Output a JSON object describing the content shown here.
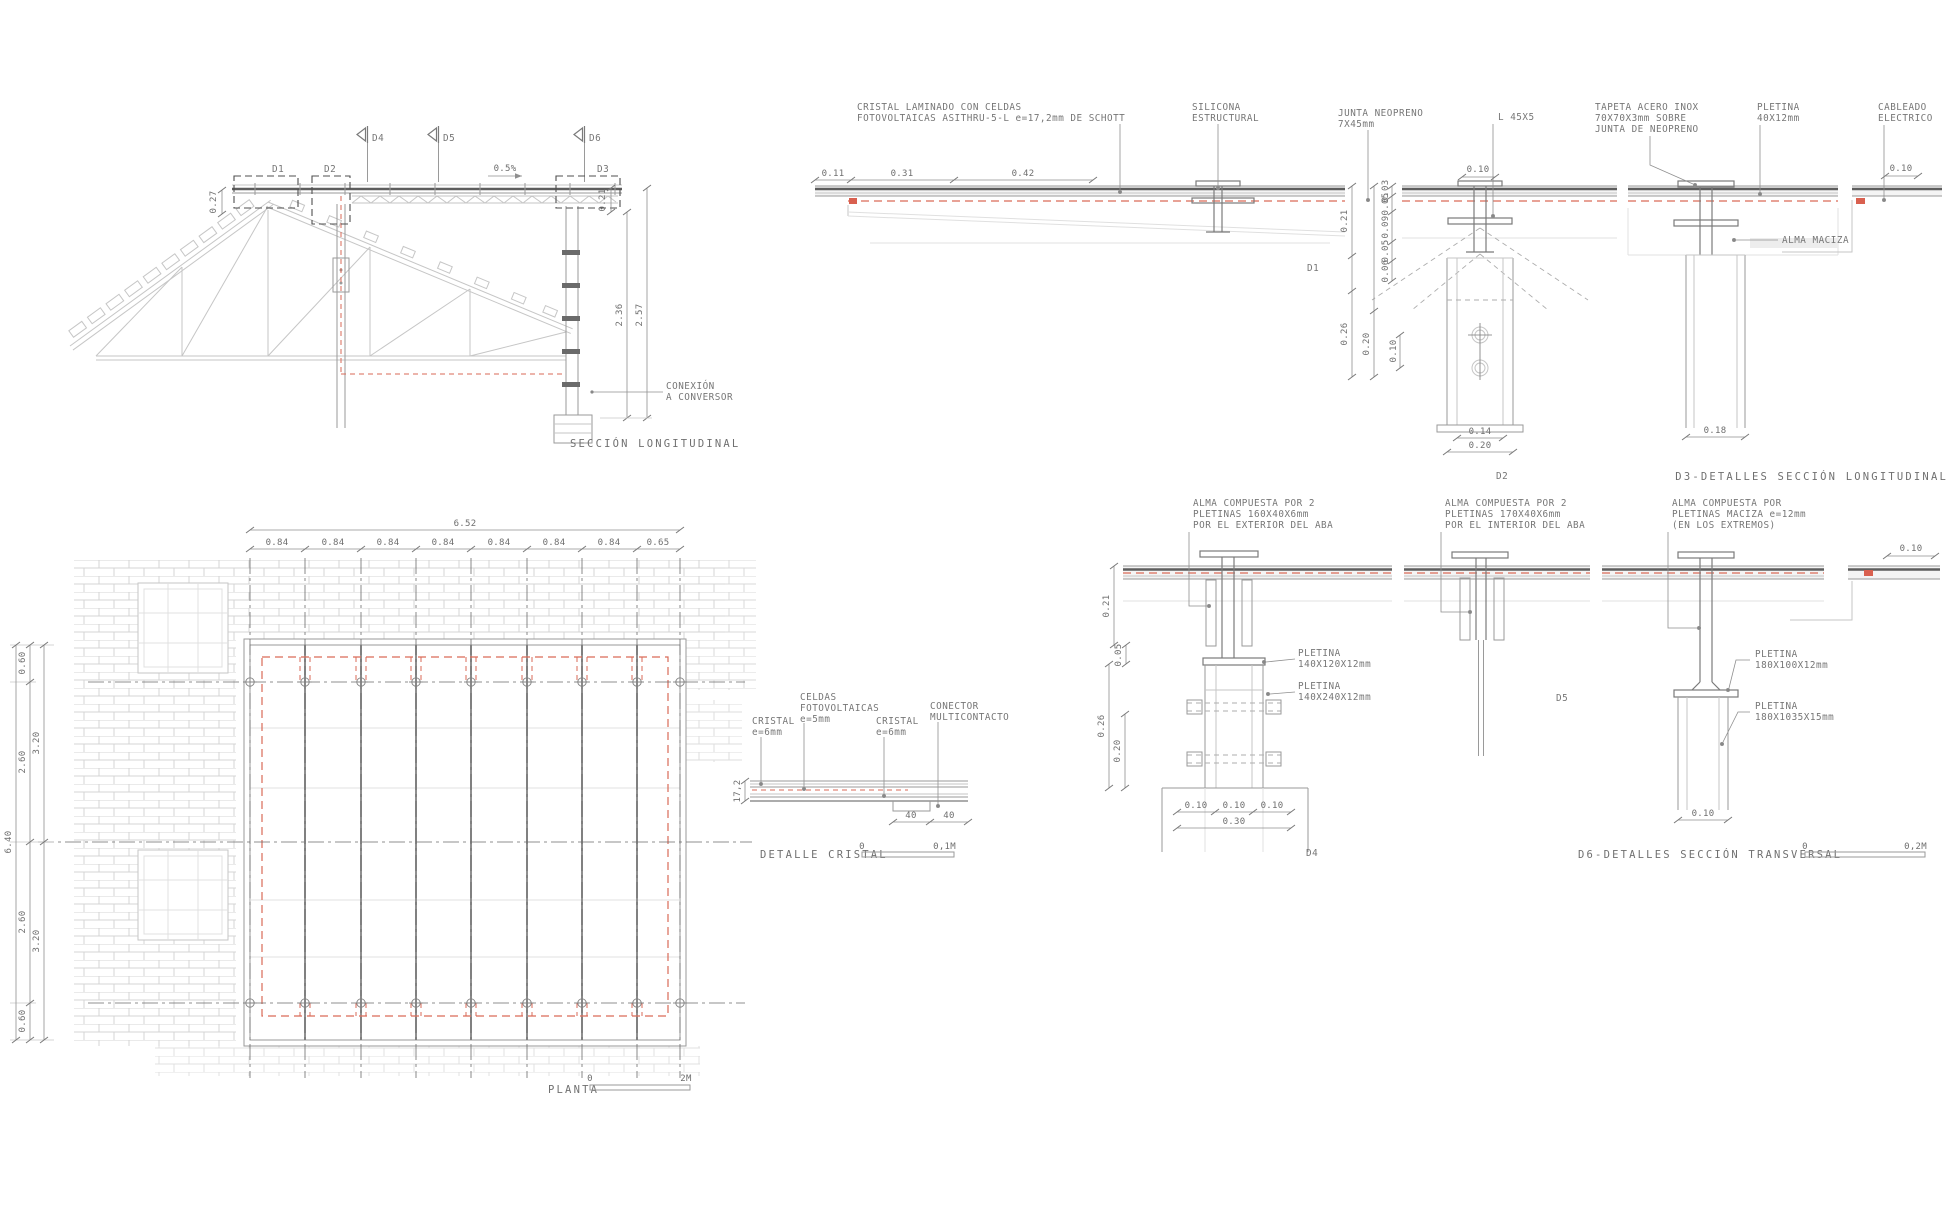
{
  "section": {
    "caption": "SECCIÓN  LONGITUDINAL",
    "flag_d4": "D4",
    "flag_d5": "D5",
    "flag_d6": "D6",
    "box_d1": "D1",
    "box_d2": "D2",
    "box_d3": "D3",
    "slope": "0.5%",
    "conexion_line1": "CONEXIÓN",
    "conexion_line2": "A CONVERSOR",
    "dim_left": "0.27",
    "dim_glass": "0.21",
    "dim_h1": "2.36",
    "dim_h2": "2.57"
  },
  "planta": {
    "caption": "PLANTA",
    "scale_zero": "0",
    "scale_end": "2M",
    "dim_total_w": "6.52",
    "dim_bay": "0.84",
    "dim_last_bay": "0.65",
    "dim_total_h": "6.40",
    "dim_edge": "0.60",
    "dim_half": "2.60",
    "dim_mid": "3.20"
  },
  "cristal": {
    "caption": "DETALLE  CRISTAL",
    "scale_zero": "0",
    "scale_end": "0,1M",
    "celdas_1": "CELDAS",
    "celdas_2": "FOTOVOLTAICAS",
    "celdas_3": "e=5mm",
    "cristal_1": "CRISTAL",
    "cristal_2": "e=6mm",
    "conector_1": "CONECTOR",
    "conector_2": "MULTICONTACTO",
    "dim_40": "40",
    "dim_thickness": "17,2"
  },
  "row1": {
    "caption": "D3-DETALLES  SECCIÓN  LONGITUDINAL",
    "label_d1": "D1",
    "label_d2": "D2",
    "cristal_1": "CRISTAL LAMINADO CON CELDAS",
    "cristal_2": "FOTOVOLTAICAS ASITHRU-5-L e=17,2mm DE SCHOTT",
    "silicona_1": "SILICONA",
    "silicona_2": "ESTRUCTURAL",
    "junta_1": "JUNTA NEOPRENO",
    "junta_2": "7X45mm",
    "l45": "L 45X5",
    "tapeta_1": "TAPETA ACERO INOX",
    "tapeta_2": "70X70X3mm SOBRE",
    "tapeta_3": "JUNTA DE NEOPRENO",
    "pletina_1": "PLETINA",
    "pletina_2": "40X12mm",
    "cableado_1": "CABLEADO",
    "cableado_2": "ELECTRICO",
    "alma_maciza": "ALMA MACIZA",
    "d011": "0.11",
    "d031": "0.31",
    "d042": "0.42",
    "d010": "0.10",
    "d003": "0.03",
    "d005": "0.05",
    "d009": "0.09",
    "d006": "0.06",
    "d021": "0.21",
    "d026": "0.26",
    "d020": "0.20",
    "d014": "0.14",
    "d018": "0.18"
  },
  "row2": {
    "caption": "D6-DETALLES  SECCIÓN  TRANSVERSAL",
    "label_d4": "D4",
    "label_d5": "D5",
    "scale_zero": "0",
    "scale_end": "0,2M",
    "alma_ext_1": "ALMA COMPUESTA POR 2",
    "alma_ext_2": "PLETINAS 160X40X6mm",
    "alma_ext_3": "POR EL EXTERIOR DEL ABA",
    "alma_int_1": "ALMA COMPUESTA POR 2",
    "alma_int_2": "PLETINAS 170X40X6mm",
    "alma_int_3": "POR EL INTERIOR DEL ABA",
    "alma_mac_1": "ALMA COMPUESTA POR",
    "alma_mac_2": "PLETINAS MACIZA e=12mm",
    "alma_mac_3": "(EN LOS EXTREMOS)",
    "pletina": "PLETINA",
    "pl_140_120": "140X120X12mm",
    "pl_140_240": "140X240X12mm",
    "pl_180_100": "180X100X12mm",
    "pl_180_1035": "180X1035X15mm",
    "d021": "0.21",
    "d005": "0.05",
    "d026": "0.26",
    "d020": "0.20",
    "d010": "0.10",
    "d030": "0.30"
  }
}
